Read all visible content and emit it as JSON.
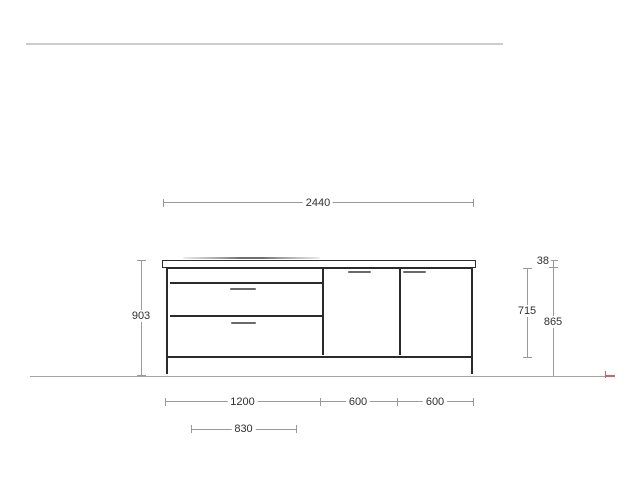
{
  "colors": {
    "background": "#ffffff",
    "drawing_line": "#2b2b2b",
    "dimension_line": "#9a9a9a",
    "dimension_text": "#303030",
    "top_reference_line": "#cccccc",
    "floor_line": "#a3a3a3",
    "handle": "#6a6a6a",
    "end_marker_red": "#d4626e"
  },
  "dimensions_mm": {
    "total_width": "2440",
    "total_height": "903",
    "front_height": "715",
    "worktop_thickness": "38",
    "carcass_height": "865",
    "drawer_unit_width": "1200",
    "middle_door_width": "600",
    "right_door_width": "600",
    "hob_width": "830"
  }
}
